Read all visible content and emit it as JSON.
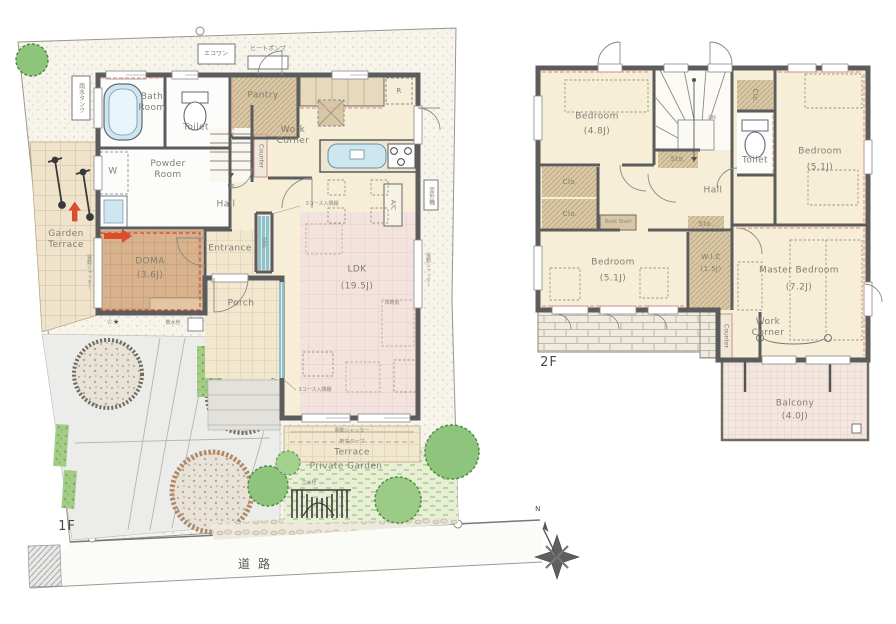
{
  "floor1": {
    "label": "1F",
    "rooms": {
      "bath": "Bath Room",
      "toilet": "Toilet",
      "powder": "Powder Room",
      "washer": "W",
      "pantry": "Pantry",
      "work_corner": "Work Corner",
      "counter": "Counter",
      "hall": "Hall",
      "up": "UP",
      "stair_sto": "Sto.",
      "entrance": "Entrance",
      "porch": "Porch",
      "doma": "DOMA",
      "doma_size": "(3.6J)",
      "ldk": "LDK",
      "ldk_size": "(19.5J)",
      "fridge": "R",
      "ac": "A/C",
      "floor_heating": "床暖房",
      "corner_shelf_upper": "3コース入隅棚",
      "corner_shelf_lower": "3コース入隅棚"
    },
    "site": {
      "garden_terrace": "Garden Terrace",
      "terrace": "Terrace",
      "private_garden": "Private Garden",
      "road": "道路",
      "eco_one": "エコワン",
      "heat_pump": "ヒートポンプ",
      "rain_tank": "雨水タンク",
      "outdoor_unit": "室外機",
      "shutter_right": "電動シャッター",
      "shutter_left": "電動シャッター",
      "shutter_terrace": "電動シャッター",
      "awning": "軒先タープ",
      "sprinkler": "散水栓",
      "stars": "☆★",
      "tap": "立水栓"
    }
  },
  "floor2": {
    "label": "2F",
    "rooms": {
      "bedroom_a": "Bedroom",
      "bedroom_a_size": "(4.8J)",
      "bedroom_b": "Bedroom",
      "bedroom_b_size": "(5.1J)",
      "bedroom_c": "Bedroom",
      "bedroom_c_size": "(5.1J)",
      "master": "Master Bedroom",
      "master_size": "(7.2J)",
      "wic": "W.I.C",
      "wic_size": "(1.5J)",
      "toilet": "Toilet",
      "hall": "Hall",
      "sto_stairs": "Sto.",
      "sto_hall": "Sto.",
      "clo_a": "Clo.",
      "clo_b": "Clo.",
      "clo_c": "Clo.",
      "book_shelf": "Book Shelf",
      "dn": "DN",
      "work_corner": "Work Corner",
      "counter": "Counter",
      "balcony": "Balcony",
      "balcony_size": "(4.0J)"
    }
  },
  "compass": {
    "north": "N"
  },
  "colors": {
    "wall": "#5c5c5c",
    "cream": "#f6eed6",
    "tan": "#d9c6a4",
    "pink_floor": "#f3e2dd",
    "doma": "#d6b08a",
    "teal": "#8fc3c9",
    "accent_red": "#d94f2b",
    "green": "#8fc47d"
  }
}
